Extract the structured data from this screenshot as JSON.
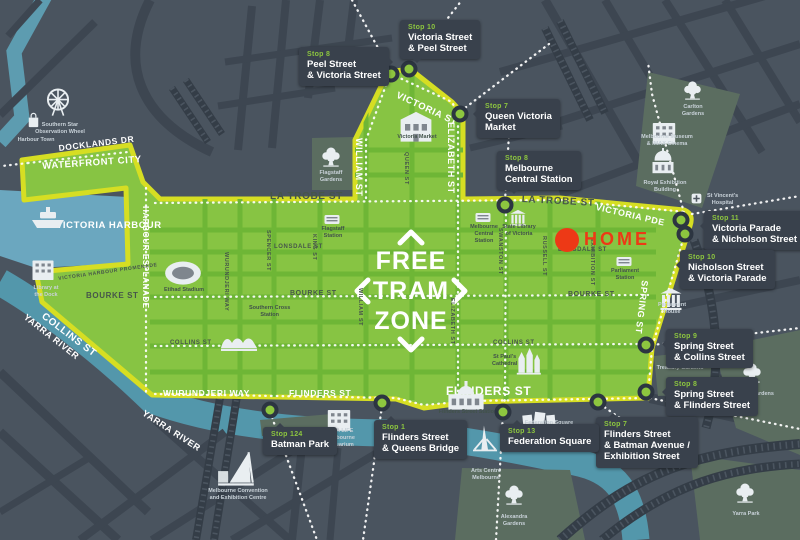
{
  "colors": {
    "background": "#4a545f",
    "road": "#3d4651",
    "park": "#5b6d60",
    "rail": "#343d47",
    "harbour": "#6ba7bf",
    "river": "#5397ab",
    "zone_fill": "#87c443",
    "zone_street": "#6eb636",
    "zone_border": "#d6de23",
    "label_box": "#39414c",
    "stop_green": "#8dc63f",
    "stop_ring": "#2c3541",
    "home_red": "#ed3916",
    "dark_text": "#46564a",
    "light_text": "#ffffff"
  },
  "zone_text": {
    "lines": [
      "FREE",
      "TRAM",
      "ZONE"
    ]
  },
  "home": {
    "label": "HOME",
    "x": 567,
    "y": 240
  },
  "stops": [
    {
      "x": 391,
      "y": 74
    },
    {
      "x": 409,
      "y": 69
    },
    {
      "x": 460,
      "y": 114
    },
    {
      "x": 505,
      "y": 205
    },
    {
      "x": 681,
      "y": 220
    },
    {
      "x": 685,
      "y": 234
    },
    {
      "x": 646,
      "y": 345
    },
    {
      "x": 646,
      "y": 392
    },
    {
      "x": 598,
      "y": 402
    },
    {
      "x": 503,
      "y": 412
    },
    {
      "x": 382,
      "y": 403
    },
    {
      "x": 270,
      "y": 410
    }
  ],
  "stop_labels": [
    {
      "id": "stop-10-victoria-peel",
      "stop": "Stop 10",
      "lines": [
        "Victoria Street",
        "& Peel Street"
      ],
      "x": 400,
      "y": 20,
      "ptr": "bottom"
    },
    {
      "id": "stop-8-peel-victoria",
      "stop": "Stop 8",
      "lines": [
        "Peel Street",
        "& Victoria Street"
      ],
      "x": 299,
      "y": 47,
      "ptr": "right"
    },
    {
      "id": "stop-7-queen-victoria-market",
      "stop": "Stop 7",
      "lines": [
        "Queen Victoria",
        "Market"
      ],
      "x": 477,
      "y": 99,
      "ptr": "left"
    },
    {
      "id": "stop-8-melbourne-central",
      "stop": "Stop 8",
      "lines": [
        "Melbourne",
        "Central Station"
      ],
      "x": 497,
      "y": 151,
      "ptr": "bottom"
    },
    {
      "id": "stop-11-victoria-nicholson",
      "stop": "Stop 11",
      "lines": [
        "Victoria Parade",
        "& Nicholson Street"
      ],
      "x": 704,
      "y": 211,
      "ptr": "left"
    },
    {
      "id": "stop-10-nicholson-victoria",
      "stop": "Stop 10",
      "lines": [
        "Nicholson Street",
        "& Victoria Parade"
      ],
      "x": 680,
      "y": 250,
      "ptr": "left"
    },
    {
      "id": "stop-9-spring-collins",
      "stop": "Stop 9",
      "lines": [
        "Spring Street",
        "& Collins Street"
      ],
      "x": 666,
      "y": 329,
      "ptr": "left"
    },
    {
      "id": "stop-8-spring-flinders",
      "stop": "Stop 8",
      "lines": [
        "Spring Street",
        "& Flinders Street"
      ],
      "x": 666,
      "y": 377,
      "ptr": "left"
    },
    {
      "id": "stop-7-flinders-batman",
      "stop": "Stop 7",
      "lines": [
        "Flinders Street",
        "& Batman Avenue /",
        "Exhibition Street"
      ],
      "x": 596,
      "y": 417,
      "ptr": "top"
    },
    {
      "id": "stop-13-federation-square",
      "stop": "Stop 13",
      "lines": [
        "Federation Square"
      ],
      "x": 500,
      "y": 424,
      "ptr": "top"
    },
    {
      "id": "stop-1-flinders-queens",
      "stop": "Stop 1",
      "lines": [
        "Flinders Street",
        "& Queens Bridge"
      ],
      "x": 374,
      "y": 420,
      "ptr": "top"
    },
    {
      "id": "stop-124-batman-park",
      "stop": "Stop 124",
      "lines": [
        "Batman Park"
      ],
      "x": 263,
      "y": 427,
      "ptr": "top"
    }
  ],
  "street_labels": [
    {
      "text": "DOCKLANDS DR",
      "x": 58,
      "y": 143,
      "rot": -7,
      "size": 8.5,
      "tone": "light"
    },
    {
      "text": "WATERFRONT CITY",
      "x": 42,
      "y": 161,
      "rot": -4,
      "size": 9.5,
      "tone": "light"
    },
    {
      "text": "HARBOUR ESPLANADE",
      "x": 150,
      "y": 206,
      "rot": 90,
      "size": 8,
      "tone": "light"
    },
    {
      "text": "VICTORIA HARBOUR",
      "x": 56,
      "y": 220,
      "rot": 0,
      "size": 9.5,
      "tone": "light"
    },
    {
      "text": "VICTORIA HARBOUR PROMENADE",
      "x": 58,
      "y": 276,
      "rot": -8,
      "size": 5,
      "tone": "dark"
    },
    {
      "text": "YARRA RIVER",
      "x": 28,
      "y": 312,
      "rot": 38,
      "size": 9,
      "tone": "light"
    },
    {
      "text": "YARRA RIVER",
      "x": 146,
      "y": 408,
      "rot": 33,
      "size": 9,
      "tone": "light"
    },
    {
      "text": "WURUNDJERI WAY",
      "x": 163,
      "y": 388,
      "rot": 0,
      "size": 8.5,
      "tone": "light"
    },
    {
      "text": "FLINDERS ST",
      "x": 289,
      "y": 388,
      "rot": 0,
      "size": 8.5,
      "tone": "light"
    },
    {
      "text": "FLINDERS ST",
      "x": 446,
      "y": 384,
      "rot": 0,
      "size": 12,
      "tone": "light"
    },
    {
      "text": "LA TROBE ST",
      "x": 270,
      "y": 191,
      "rot": 0,
      "size": 10,
      "tone": "dark"
    },
    {
      "text": "LA TROBE ST",
      "x": 522,
      "y": 194,
      "rot": 3,
      "size": 10,
      "tone": "dark"
    },
    {
      "text": "VICTORIA ST",
      "x": 399,
      "y": 90,
      "rot": 25,
      "size": 9.5,
      "tone": "light"
    },
    {
      "text": "WILLIAM ST",
      "x": 364,
      "y": 138,
      "rot": 90,
      "size": 9,
      "tone": "light"
    },
    {
      "text": "ELIZABETH ST",
      "x": 456,
      "y": 122,
      "rot": 90,
      "size": 9,
      "tone": "light"
    },
    {
      "text": "VICTORIA PDE",
      "x": 597,
      "y": 202,
      "rot": 13,
      "size": 9,
      "tone": "light"
    },
    {
      "text": "SPRING ST",
      "x": 650,
      "y": 281,
      "rot": 97,
      "size": 9,
      "tone": "light"
    },
    {
      "text": "LONSDALE ST",
      "x": 274,
      "y": 244,
      "rot": 0,
      "size": 6,
      "tone": "dark"
    },
    {
      "text": "LONSDALE ST",
      "x": 558,
      "y": 247,
      "rot": 0,
      "size": 6,
      "tone": "dark"
    },
    {
      "text": "BOURKE ST",
      "x": 86,
      "y": 291,
      "rot": 0,
      "size": 8,
      "tone": "dark"
    },
    {
      "text": "BOURKE ST",
      "x": 290,
      "y": 290,
      "rot": 0,
      "size": 7,
      "tone": "dark"
    },
    {
      "text": "BOURKE ST",
      "x": 568,
      "y": 291,
      "rot": 0,
      "size": 7,
      "tone": "dark"
    },
    {
      "text": "COLLINS ST",
      "x": 46,
      "y": 311,
      "rot": 37,
      "size": 10,
      "tone": "light"
    },
    {
      "text": "COLLINS ST",
      "x": 170,
      "y": 340,
      "rot": 0,
      "size": 6,
      "tone": "dark"
    },
    {
      "text": "COLLINS ST",
      "x": 493,
      "y": 340,
      "rot": 0,
      "size": 6,
      "tone": "dark"
    },
    {
      "text": "SPENCER ST",
      "x": 271,
      "y": 230,
      "rot": 90,
      "size": 5.5,
      "tone": "dark"
    },
    {
      "text": "KING ST",
      "x": 317,
      "y": 234,
      "rot": 90,
      "size": 5.5,
      "tone": "dark"
    },
    {
      "text": "WILLIAM ST",
      "x": 363,
      "y": 288,
      "rot": 90,
      "size": 5.5,
      "tone": "dark"
    },
    {
      "text": "QUEEN ST",
      "x": 409,
      "y": 152,
      "rot": 90,
      "size": 5.5,
      "tone": "dark"
    },
    {
      "text": "ELIZABETH ST",
      "x": 455,
      "y": 298,
      "rot": 90,
      "size": 5.5,
      "tone": "dark"
    },
    {
      "text": "SWANSTON ST",
      "x": 503,
      "y": 228,
      "rot": 90,
      "size": 5.5,
      "tone": "dark"
    },
    {
      "text": "RUSSELL ST",
      "x": 547,
      "y": 236,
      "rot": 90,
      "size": 5.5,
      "tone": "dark"
    },
    {
      "text": "EXHIBITION ST",
      "x": 595,
      "y": 238,
      "rot": 90,
      "size": 5.5,
      "tone": "dark"
    },
    {
      "text": "WURUNDJERI WAY",
      "x": 229,
      "y": 252,
      "rot": 90,
      "size": 5.5,
      "tone": "dark"
    }
  ],
  "landmarks": [
    {
      "id": "southern-star-wheel",
      "icon": "wheel",
      "ix": 42,
      "iy": 86,
      "w": 32,
      "cap": [
        "Southern Star",
        "Observation Wheel"
      ],
      "cx": 60,
      "cy": 122,
      "tone": "light",
      "anchor": "center"
    },
    {
      "id": "harbour-town",
      "icon": "bag",
      "ix": 24,
      "iy": 110,
      "w": 19,
      "cap": [
        "Harbour Town"
      ],
      "cx": 36,
      "cy": 137,
      "tone": "light",
      "anchor": "center"
    },
    {
      "id": "harbour-ship",
      "icon": "ship",
      "ix": 28,
      "iy": 194,
      "w": 40,
      "cap": [],
      "cx": 0,
      "cy": 0,
      "tone": "light",
      "anchor": "center"
    },
    {
      "id": "library-at-the-dock",
      "icon": "building",
      "ix": 28,
      "iy": 253,
      "w": 30,
      "cap": [
        "Library at",
        "the Dock"
      ],
      "cx": 46,
      "cy": 285,
      "tone": "light",
      "anchor": "center"
    },
    {
      "id": "etihad-stadium",
      "icon": "stadium",
      "ix": 162,
      "iy": 250,
      "w": 42,
      "cap": [
        "Etihad Stadium"
      ],
      "cx": 184,
      "cy": 287,
      "tone": "dark",
      "anchor": "center"
    },
    {
      "id": "southern-cross-station",
      "icon": "waves",
      "ix": 219,
      "iy": 318,
      "w": 40,
      "cap": [
        "Southern Cross",
        "Station"
      ],
      "cx": 249,
      "cy": 305,
      "tone": "dark",
      "anchor": "left"
    },
    {
      "id": "flagstaff-gardens",
      "icon": "tree",
      "ix": 320,
      "iy": 145,
      "w": 22,
      "cap": [
        "Flagstaff",
        "Gardens"
      ],
      "cx": 331,
      "cy": 170,
      "tone": "light",
      "anchor": "center"
    },
    {
      "id": "flagstaff-station",
      "icon": "station",
      "ix": 322,
      "iy": 209,
      "w": 20,
      "cap": [
        "Flagstaff",
        "Station"
      ],
      "cx": 333,
      "cy": 226,
      "tone": "dark",
      "anchor": "center"
    },
    {
      "id": "queen-victoria-market",
      "icon": "market",
      "ix": 394,
      "iy": 102,
      "w": 44,
      "cap": [
        "Victoria Market"
      ],
      "cx": 417,
      "cy": 134,
      "tone": "dark",
      "anchor": "center"
    },
    {
      "id": "melbourne-central-station",
      "icon": "station",
      "ix": 473,
      "iy": 207,
      "w": 20,
      "cap": [
        "Melbourne",
        "Central",
        "Station"
      ],
      "cx": 484,
      "cy": 224,
      "tone": "dark",
      "anchor": "center"
    },
    {
      "id": "state-library",
      "icon": "columns",
      "ix": 507,
      "iy": 206,
      "w": 22,
      "cap": [
        "State Library",
        "of Victoria"
      ],
      "cx": 519,
      "cy": 224,
      "tone": "dark",
      "anchor": "center"
    },
    {
      "id": "parliament-station",
      "icon": "station",
      "ix": 614,
      "iy": 251,
      "w": 20,
      "cap": [
        "Parliament",
        "Station"
      ],
      "cx": 625,
      "cy": 268,
      "tone": "dark",
      "anchor": "center"
    },
    {
      "id": "parliament-house",
      "icon": "columns",
      "ix": 656,
      "iy": 283,
      "w": 30,
      "cap": [
        "Parliament",
        "House"
      ],
      "cx": 672,
      "cy": 302,
      "tone": "light",
      "anchor": "center"
    },
    {
      "id": "st-vincents-hospital",
      "icon": "cross",
      "ix": 690,
      "iy": 192,
      "w": 13,
      "cap": [
        "St Vincent's",
        "Hospital"
      ],
      "cx": 707,
      "cy": 193,
      "tone": "light",
      "anchor": "left"
    },
    {
      "id": "carlton-gardens",
      "icon": "tree",
      "ix": 682,
      "iy": 79,
      "w": 21,
      "cap": [
        "Carlton",
        "Gardens"
      ],
      "cx": 693,
      "cy": 104,
      "tone": "light",
      "anchor": "center"
    },
    {
      "id": "melbourne-museum",
      "icon": "building",
      "ix": 648,
      "iy": 115,
      "w": 32,
      "cap": [
        "Melbourne Museum",
        "& IMAX Cinema"
      ],
      "cx": 667,
      "cy": 134,
      "tone": "light",
      "anchor": "center"
    },
    {
      "id": "royal-exhibition-building",
      "icon": "dome",
      "ix": 649,
      "iy": 148,
      "w": 28,
      "cap": [
        "Royal Exhibition",
        "Building"
      ],
      "cx": 665,
      "cy": 180,
      "tone": "light",
      "anchor": "center"
    },
    {
      "id": "st-pauls-cathedral",
      "icon": "church",
      "ix": 512,
      "iy": 344,
      "w": 32,
      "cap": [
        "St Paul's",
        "Cathedral"
      ],
      "cx": 492,
      "cy": 354,
      "tone": "dark",
      "anchor": "left"
    },
    {
      "id": "flinders-street-station",
      "icon": "flinders",
      "ix": 444,
      "iy": 370,
      "w": 44,
      "cap": [
        "Flinders Street Station"
      ],
      "cx": 468,
      "cy": 409,
      "tone": "dark",
      "anchor": "center"
    },
    {
      "id": "federation-square",
      "icon": "blocks",
      "ix": 520,
      "iy": 398,
      "w": 38,
      "cap": [
        "Federation Square"
      ],
      "cx": 549,
      "cy": 420,
      "tone": "light",
      "anchor": "center"
    },
    {
      "id": "sea-life-aquarium",
      "icon": "building",
      "ix": 323,
      "iy": 402,
      "w": 32,
      "cap": [
        "SEA LIFE",
        "Melbourne",
        "Aquarium"
      ],
      "cx": 341,
      "cy": 428,
      "tone": "light",
      "anchor": "center"
    },
    {
      "id": "arts-centre-melbourne",
      "icon": "spire",
      "ix": 470,
      "iy": 424,
      "w": 30,
      "cap": [
        "Arts Centre",
        "Melbourne"
      ],
      "cx": 486,
      "cy": 468,
      "tone": "light",
      "anchor": "center"
    },
    {
      "id": "alexandra-gardens",
      "icon": "tree",
      "ix": 503,
      "iy": 483,
      "w": 22,
      "cap": [
        "Alexandra",
        "Gardens"
      ],
      "cx": 514,
      "cy": 514,
      "tone": "light",
      "anchor": "center"
    },
    {
      "id": "melbourne-convention-centre",
      "icon": "convention",
      "ix": 216,
      "iy": 448,
      "w": 42,
      "cap": [
        "Melbourne Convention",
        "and Exhibition Centre"
      ],
      "cx": 238,
      "cy": 488,
      "tone": "light",
      "anchor": "center"
    },
    {
      "id": "yarra-park",
      "icon": "tree",
      "ix": 734,
      "iy": 481,
      "w": 22,
      "cap": [
        "Yarra Park"
      ],
      "cx": 746,
      "cy": 511,
      "tone": "light",
      "anchor": "center"
    },
    {
      "id": "fitzroy-gardens",
      "icon": "tree",
      "ix": 741,
      "iy": 361,
      "w": 22,
      "cap": [
        "Fitzroy Gardens"
      ],
      "cx": 753,
      "cy": 391,
      "tone": "light",
      "anchor": "center"
    },
    {
      "id": "treasury-gardens",
      "icon": "none",
      "ix": 0,
      "iy": 0,
      "w": 0,
      "cap": [
        "Treasury Gardens"
      ],
      "cx": 680,
      "cy": 365,
      "tone": "light",
      "anchor": "center"
    }
  ]
}
